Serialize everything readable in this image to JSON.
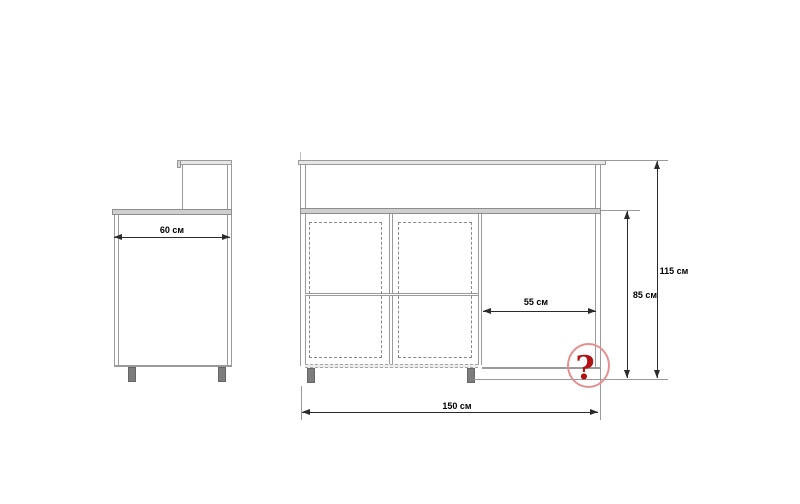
{
  "drawing": {
    "type": "furniture-dimension-drawing",
    "labels": {
      "side_depth": "60 см",
      "opening_width": "55 см",
      "worktop_height": "85 см",
      "total_height": "115 см",
      "front_width": "150 см",
      "unknown": "?"
    }
  },
  "colors": {
    "line": "#9a9a9a",
    "line-light": "#c0c0c0",
    "board-fill": "#e7e7e7",
    "counter-fill": "#cfcfcf",
    "leg-fill": "#7d7d7d",
    "dim": "#2b2b2b",
    "circle-red": "#e59090",
    "question-red": "#b21212",
    "bg": "#ffffff"
  }
}
